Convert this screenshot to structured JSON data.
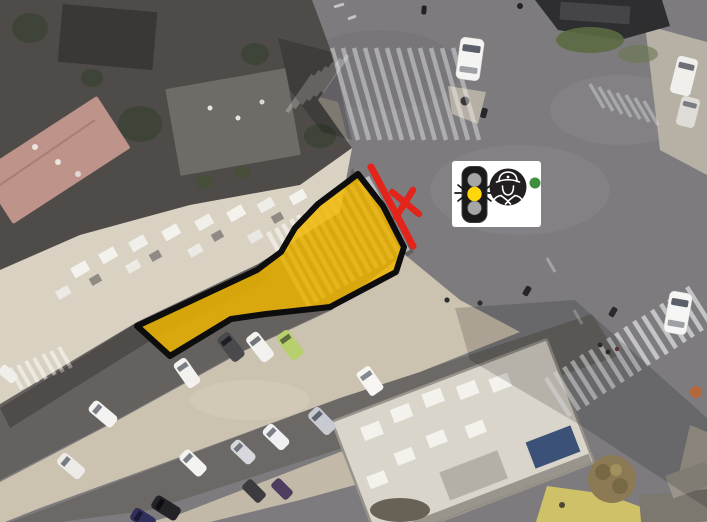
{
  "meta": {
    "description": "Aerial drone photo of a city intersection with a highlighted restricted zone, a red road-closure line with X mark, and a traffic-signal / police-officer badge",
    "canvas": {
      "width": 707,
      "height": 522
    }
  },
  "annotations": {
    "restricted_zone": {
      "name": "restricted-area-polygon",
      "fill": "#F0B600",
      "fill_opacity": "0.84",
      "border_color": "#0D0D0D"
    },
    "closure_line": {
      "name": "closure-line",
      "color": "#E3241B"
    },
    "x_mark": {
      "name": "closure-x-mark",
      "color": "#E3241B"
    },
    "signal_badge": {
      "name": "traffic-signal-officer-badge",
      "state": "yellow-light-active",
      "background": "#FFFFFF",
      "housing_color": "#1A1A1A",
      "active_light_color": "#FFD60A",
      "inactive_light_color": "#A6A6A6",
      "officer_circle_color": "#231E1F",
      "officer_line_color": "#FFFFFF",
      "green_dot_color": "#3E8E3E"
    }
  },
  "icons": [
    "traffic-light-icon",
    "police-officer-icon",
    "closure-x-mark"
  ],
  "scene": {
    "palette": {
      "asphalt": "#7D7B7E",
      "asphalt_dark": "#64615E",
      "asphalt_lower": "#6B6865",
      "sand": "#CCC2B0",
      "sand_light": "#C3B9A8",
      "rooftop_light": "#D9D2C3",
      "rooftop_dark": "#4E4B48",
      "rooftop_pink": "#BD938A",
      "building_bottom_right": "#D9D5CB",
      "sidewalk": "#B6B0A5",
      "crosswalk_white": "#FFFFFF",
      "vegetation": "#3E4437",
      "tree_autumn": "#8B7A54"
    }
  }
}
